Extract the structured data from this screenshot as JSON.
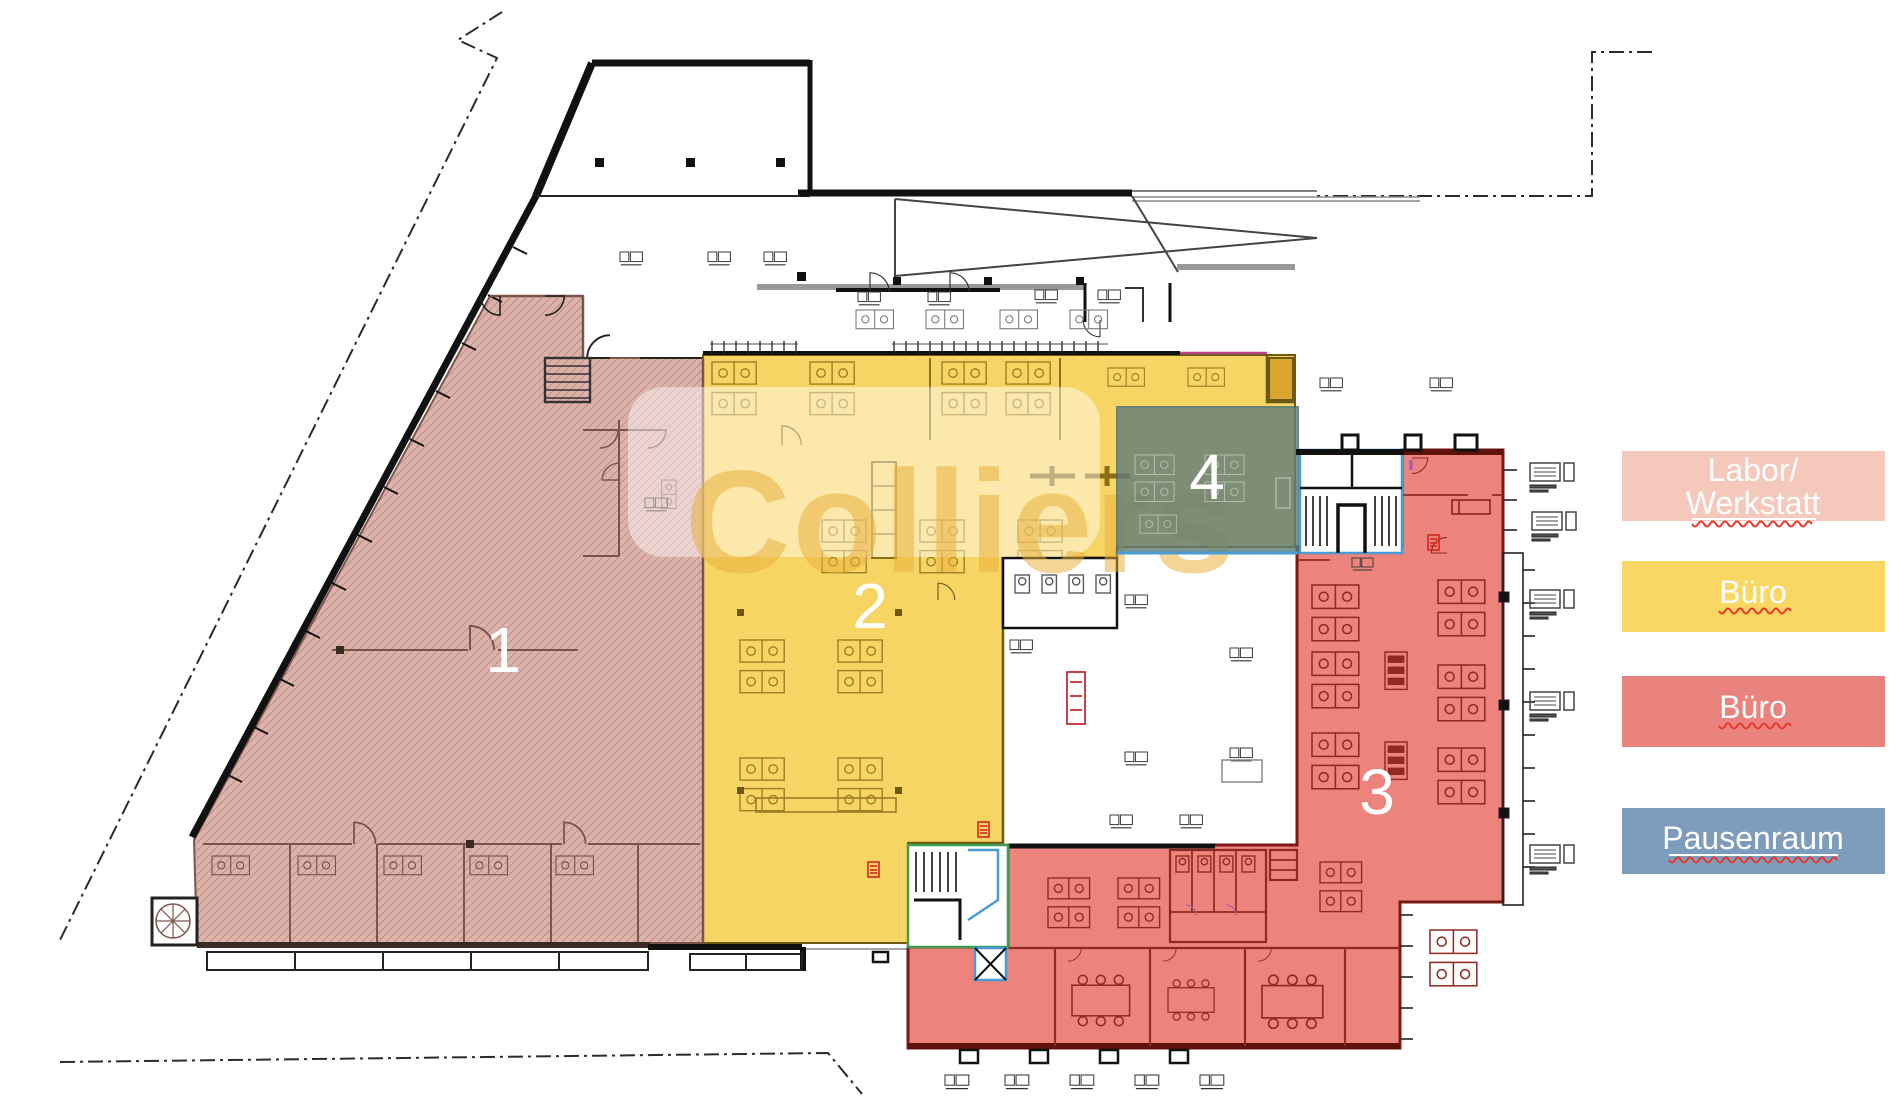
{
  "title": "Grundriss mit Flächenkennzeichnung",
  "watermark": {
    "text": "Colliers",
    "band_color": "#ffffff",
    "letter_color": "#e8b03a"
  },
  "zones": [
    {
      "id": "1",
      "label": "1",
      "use": "Labor/Werkstatt",
      "fill": "#dcb3ab"
    },
    {
      "id": "2",
      "label": "2",
      "use": "Büro",
      "fill": "#f7d564"
    },
    {
      "id": "3",
      "label": "3",
      "use": "Büro",
      "fill": "#ec837d"
    },
    {
      "id": "4",
      "label": "4",
      "use": "Pausenraum",
      "fill": "#5f7d78"
    }
  ],
  "legend": {
    "items": [
      {
        "lines": [
          "Labor/",
          "Werkstatt"
        ],
        "color": "#f4c9bc"
      },
      {
        "lines": [
          "Büro"
        ],
        "color": "#fad763"
      },
      {
        "lines": [
          "Büro"
        ],
        "color": "#ea827e"
      },
      {
        "lines": [
          "Pausenraum"
        ],
        "color": "#7e9cbc"
      }
    ],
    "text_color": "#ffffff",
    "spellcheck_color": "#e8392b"
  }
}
